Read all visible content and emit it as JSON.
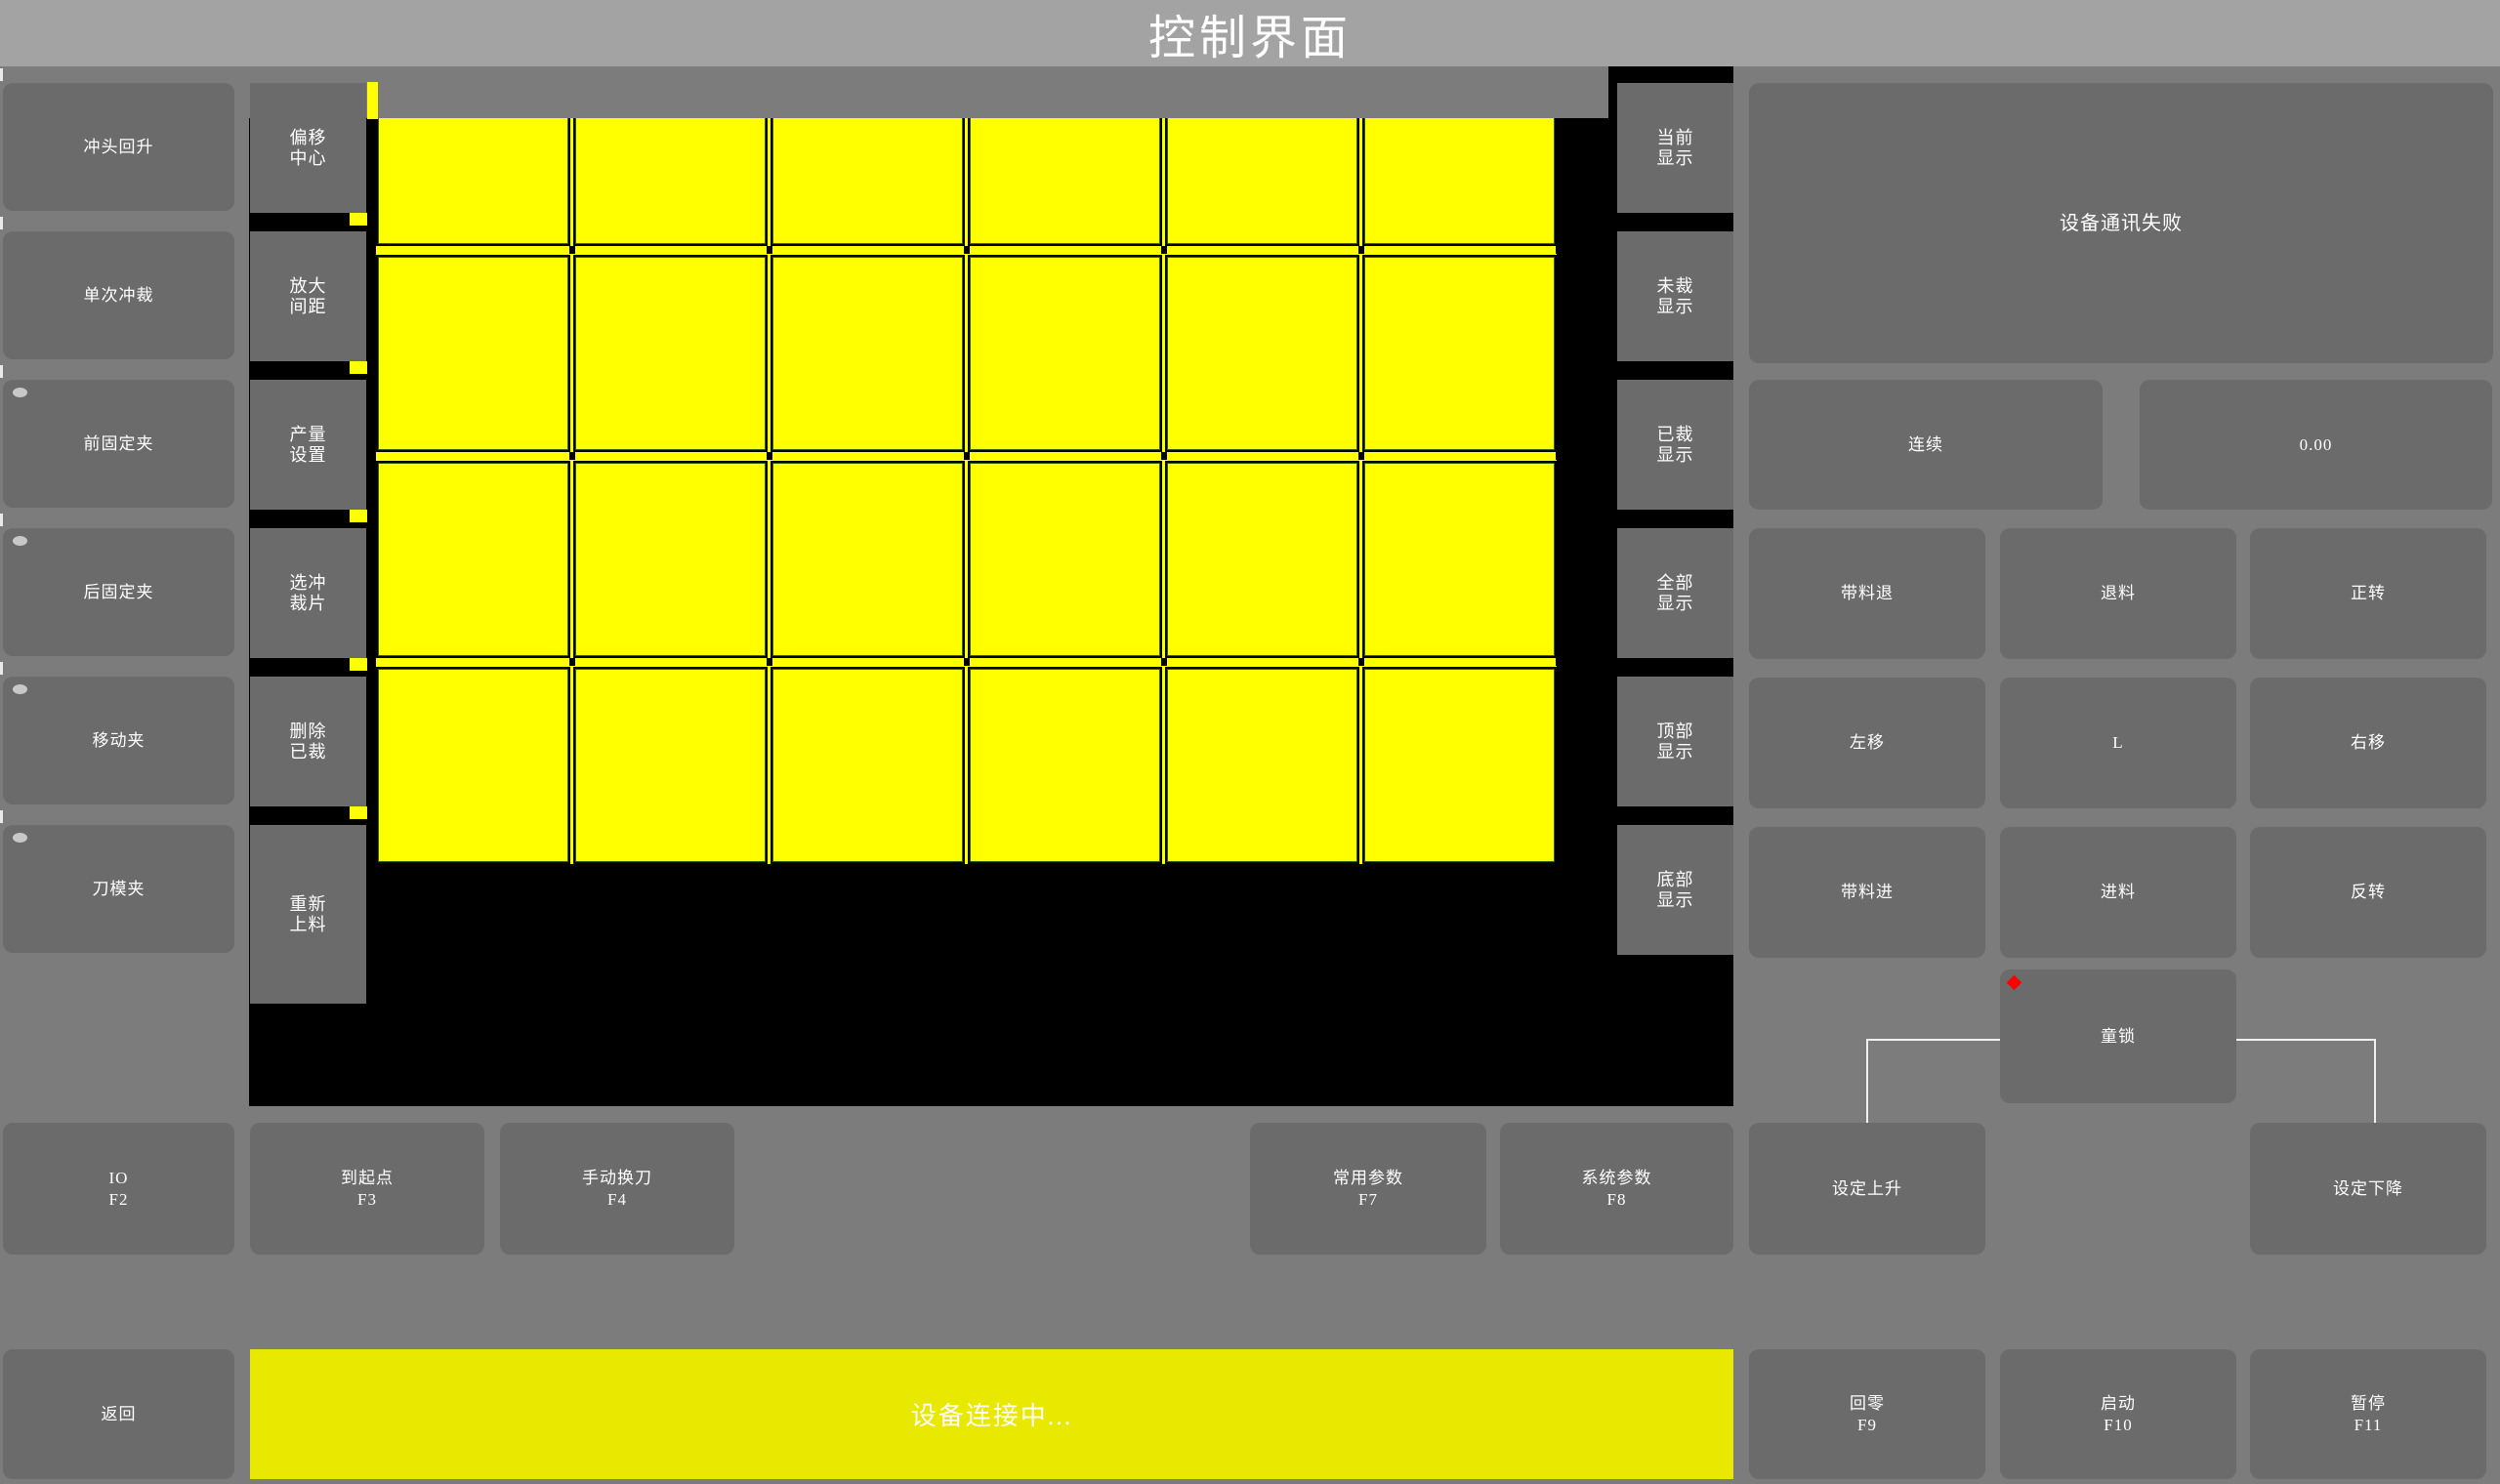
{
  "title": "控制界面",
  "left_panel": {
    "buttons": [
      {
        "label": "冲头回升",
        "indicator": false
      },
      {
        "label": "单次冲裁",
        "indicator": false
      },
      {
        "label": "前固定夹",
        "indicator": true
      },
      {
        "label": "后固定夹",
        "indicator": true
      },
      {
        "label": "移动夹",
        "indicator": true
      },
      {
        "label": "刀模夹",
        "indicator": true
      }
    ]
  },
  "tool_column": {
    "buttons": [
      {
        "l1": "偏移",
        "l2": "中心"
      },
      {
        "l1": "放大",
        "l2": "间距"
      },
      {
        "l1": "产量",
        "l2": "设置"
      },
      {
        "l1": "选冲",
        "l2": "裁片"
      },
      {
        "l1": "删除",
        "l2": "已裁"
      },
      {
        "l1": "重新",
        "l2": "上料"
      }
    ]
  },
  "display_column": {
    "buttons": [
      {
        "l1": "当前",
        "l2": "显示"
      },
      {
        "l1": "未裁",
        "l2": "显示"
      },
      {
        "l1": "已裁",
        "l2": "显示"
      },
      {
        "l1": "全部",
        "l2": "显示"
      },
      {
        "l1": "顶部",
        "l2": "显示"
      },
      {
        "l1": "底部",
        "l2": "显示"
      }
    ]
  },
  "canvas": {
    "grid": {
      "rows": 4,
      "cols": 6
    }
  },
  "right_panel": {
    "status_message": "设备通讯失败",
    "mode_button": "连续",
    "value_display": "0.00",
    "jog_buttons": [
      "带料退",
      "退料",
      "正转",
      "左移",
      "L",
      "右移",
      "带料进",
      "进料",
      "反转"
    ],
    "child_lock": "童锁",
    "set_up": "设定上升",
    "set_down": "设定下降"
  },
  "function_keys": [
    {
      "l1": "IO",
      "l2": "F2"
    },
    {
      "l1": "到起点",
      "l2": "F3"
    },
    {
      "l1": "手动换刀",
      "l2": "F4"
    },
    {
      "l1": "常用参数",
      "l2": "F7"
    },
    {
      "l1": "系统参数",
      "l2": "F8"
    }
  ],
  "bottom_bar": {
    "back": "返回",
    "status": "设备连接中...",
    "keys": [
      {
        "l1": "回零",
        "l2": "F9"
      },
      {
        "l1": "启动",
        "l2": "F10"
      },
      {
        "l1": "暂停",
        "l2": "F11"
      }
    ]
  },
  "colors": {
    "background": "#7c7c7c",
    "titlebar": "#a3a3a3",
    "button": "#6b6b6b",
    "canvas_black": "#000000",
    "piece_yellow": "#ffff00",
    "piece_border_green": "#2f6000",
    "status_bar_yellow": "#e8e800",
    "alert_red": "#ff0000",
    "connector_line": "#f0f0f0",
    "indicator_gray": "#c8c8c8",
    "text": "#ffffff"
  }
}
